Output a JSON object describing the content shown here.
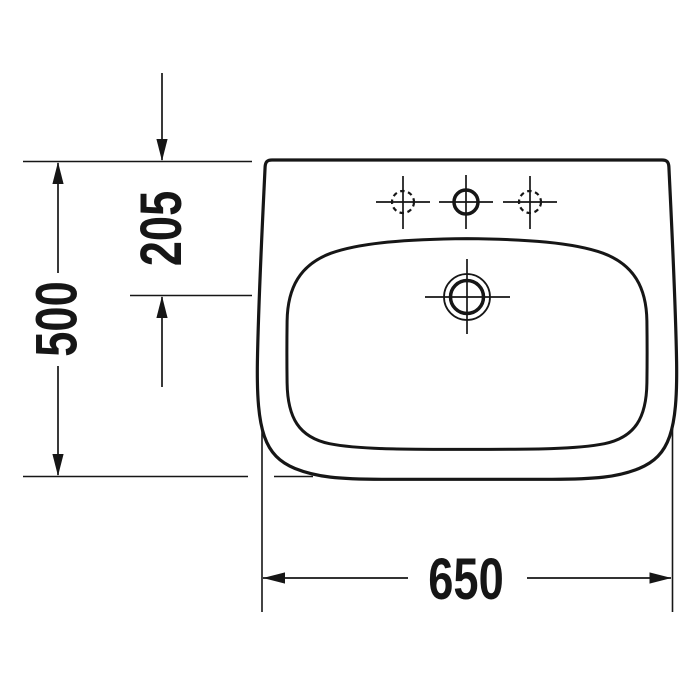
{
  "canvas": {
    "background": "#ffffff",
    "line_color": "#161616"
  },
  "drawing": {
    "type": "technical-dimension-diagram",
    "subject": "washbasin top view",
    "dimension_labels": {
      "depth_overall": "500",
      "depth_front_to_drain": "205",
      "width_overall": "650"
    },
    "icons": {
      "tap_hole_center": "solid circle with crosshair",
      "tap_hole_left": "dashed circle with crosshair",
      "tap_hole_right": "dashed circle with crosshair",
      "drain": "double circle with crosshair"
    }
  }
}
